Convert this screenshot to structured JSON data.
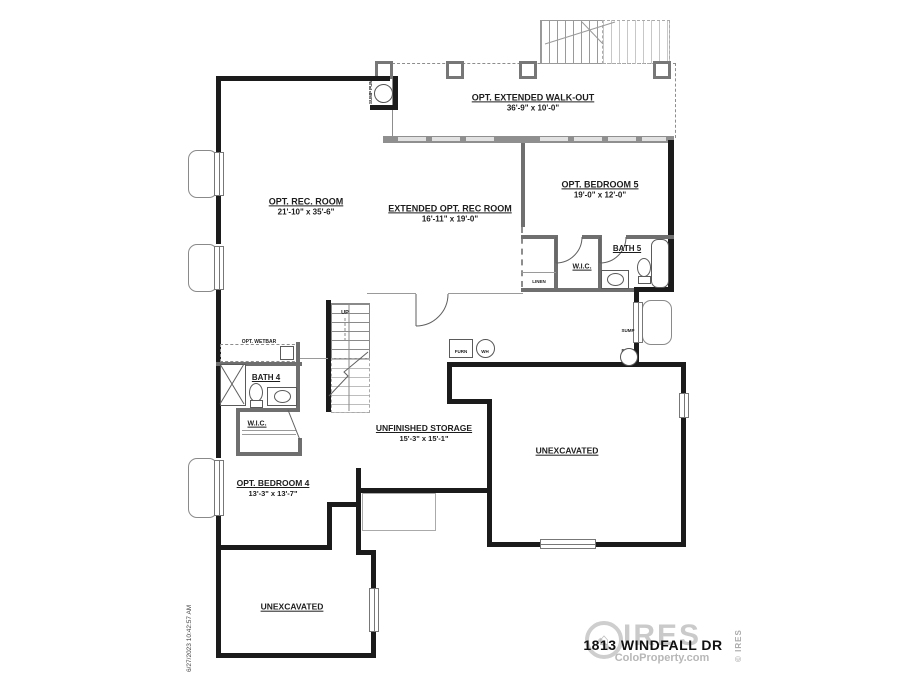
{
  "rooms": {
    "walkout": {
      "name": "OPT. EXTENDED WALK-OUT",
      "dims": "36'-9\" x 10'-0\""
    },
    "rec": {
      "name": "OPT. REC. ROOM",
      "dims": "21'-10\" x 35'-6\""
    },
    "ext_rec": {
      "name": "EXTENDED OPT. REC ROOM",
      "dims": "16'-11\" x 19'-0\""
    },
    "bedroom5": {
      "name": "OPT. BEDROOM 5",
      "dims": "19'-0\" x 12'-0\""
    },
    "bath5": {
      "name": "BATH 5"
    },
    "wic5": {
      "name": "W.I.C."
    },
    "linen": {
      "name": "LINEN"
    },
    "bath4": {
      "name": "BATH 4"
    },
    "wic4": {
      "name": "W.I.C."
    },
    "bedroom4": {
      "name": "OPT. BEDROOM 4",
      "dims": "13'-3\" x 13'-7\""
    },
    "storage": {
      "name": "UNFINISHED STORAGE",
      "dims": "15'-3\" x 15'-1\""
    },
    "unexcavated_main": {
      "name": "UNEXCAVATED"
    },
    "unexcavated_lower": {
      "name": "UNEXCAVATED"
    }
  },
  "labels": {
    "stairs_up": "UP",
    "wetbar": "OPT. WETBAR",
    "furnace": "FURN",
    "water_heater": "WH",
    "sump_pump_top": "SUMP PUMP",
    "sump_pump_right": "SUMP PUMP"
  },
  "icons": {
    "sump_pump": "outlined-circle",
    "water_heater": "outlined-circle",
    "furnace": "outlined-square",
    "window_well": "rounded-rect",
    "house_logo": "⌂"
  },
  "watermark": {
    "brand": "IRES",
    "site": "ColoProperty.com",
    "copyright": "© IRES",
    "address": "1813 WINDFALL DR"
  },
  "meta": {
    "timestamp": "6/27/2023 10:42:57 AM"
  },
  "colors": {
    "wall": "#1b1b1b",
    "interior_wall": "#6f6f6f",
    "rear_wall": "#8f8f8f",
    "thin_line": "#9a9a9a",
    "watermark_gray": "#9e9e9e"
  }
}
